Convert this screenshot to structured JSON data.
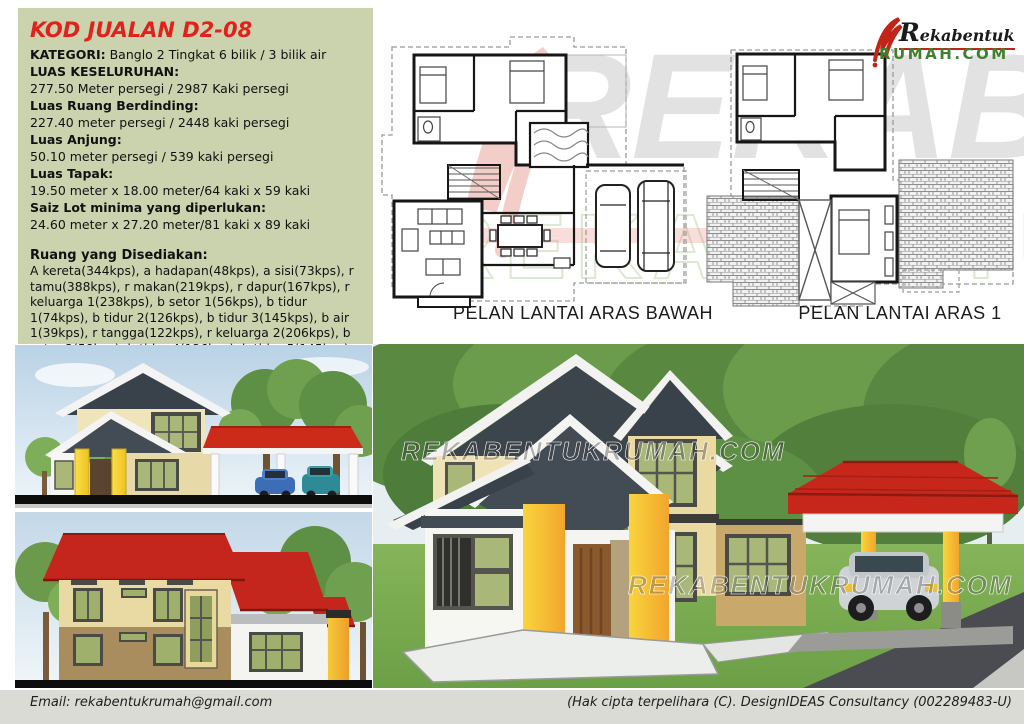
{
  "specs": {
    "title": "KOD JUALAN D2-08",
    "lines": [
      {
        "b": "KATEGORI:",
        "t": " Banglo 2 Tingkat 6 bilik / 3 bilik air"
      },
      {
        "b": "LUAS KESELURUHAN:",
        "t": ""
      },
      {
        "b": "",
        "t": "277.50 Meter persegi / 2987 Kaki persegi"
      },
      {
        "b": "Luas Ruang Berdinding:",
        "t": ""
      },
      {
        "b": "",
        "t": "227.40 meter persegi / 2448 kaki persegi"
      },
      {
        "b": "Luas Anjung:",
        "t": ""
      },
      {
        "b": "",
        "t": "50.10 meter persegi / 539 kaki persegi"
      },
      {
        "b": "Luas Tapak:",
        "t": ""
      },
      {
        "b": "",
        "t": "19.50 meter x 18.00 meter/64 kaki x 59 kaki"
      },
      {
        "b": "Saiz Lot minima yang diperlukan:",
        "t": ""
      },
      {
        "b": "",
        "t": "24.60 meter x 27.20 meter/81 kaki x 89 kaki"
      }
    ],
    "rooms_title": "Ruang yang Disediakan:",
    "rooms_text": "A kereta(344kps), a hadapan(48kps), a sisi(73kps), r tamu(388kps), r makan(219kps), r dapur(167kps), r keluarga 1(238kps), b setor 1(56kps), b tidur 1(74kps), b tidur 2(126kps), b tidur 3(145kps), b air 1(39kps), r tangga(122kps), r keluarga 2(206kps), b setor 2(58kps), b tidur 4(126kps), b tidur 5(145kps), b tidur 6(210kps), b air 2 (39kps), b air 3(41kps), & balkoni(73kps)"
  },
  "plans": {
    "ground_label": "PELAN LANTAI ARAS BAWAH",
    "first_label": "PELAN LANTAI ARAS 1"
  },
  "logo": {
    "top": "Rekabentuk",
    "bottom": "RUMAH.COM"
  },
  "watermark": {
    "text": "REKABENTUKRUMAH.COM"
  },
  "footer": {
    "email": "Email: rekabentukrumah@gmail.com",
    "copyright": "(Hak cipta terpelihara (C). DesignIDEAS Consultancy (002289483-U)"
  },
  "palette": {
    "panel_green": "#cbd3ae",
    "accent_red": "#e2211c",
    "roof_dark": "#3d454c",
    "roof_red": "#c7271b",
    "wall_cream": "#efe2b4",
    "wall_tan": "#c2a269",
    "pillar_yellow": "#f6c832",
    "window_green": "#a9b878",
    "grass_green": "#79a94f",
    "logo_green": "#3f7f2d",
    "footer_bg": "#dadbd5"
  }
}
